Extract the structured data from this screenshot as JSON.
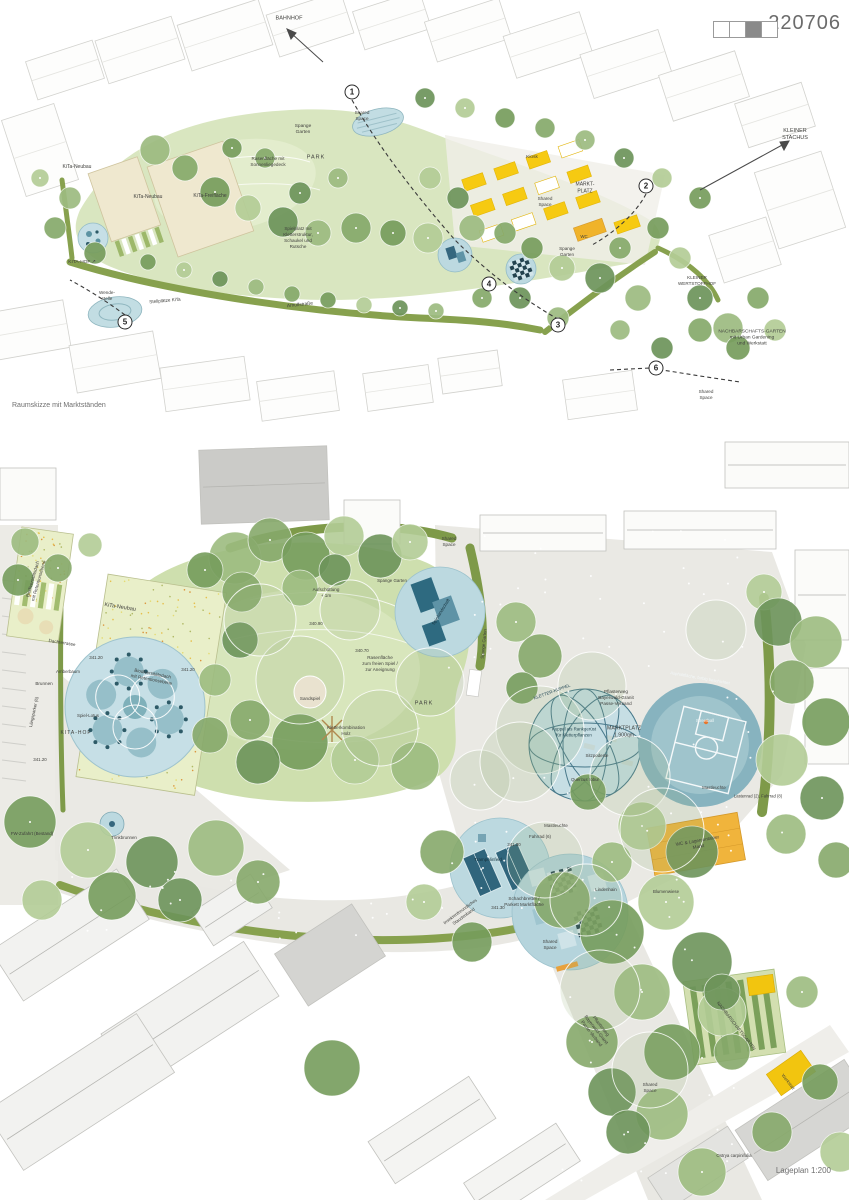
{
  "header": {
    "entry_number": "220706",
    "legend_cells": [
      "empty",
      "empty",
      "filled",
      "empty"
    ]
  },
  "colors": {
    "accent_yellow": "#f5c816",
    "amber": "#f0b43c",
    "water_blue": "#bcd9e0",
    "dark_teal": "#2f6b80",
    "park_green": "#cfe0af",
    "tree_green": "#86a96a",
    "street_gray": "#eae9e4",
    "roof_green": "#e9efc9",
    "legend_fill": "#8a8a8a"
  },
  "sketch": {
    "caption": "Raumskizze mit Marktständen",
    "labels": [
      {
        "t": "BAHNHOF",
        "x": 289,
        "y": 19,
        "s": 5.5
      },
      {
        "t": "KLEINER\nSTACHUS",
        "x": 795,
        "y": 135,
        "s": 5.5
      },
      {
        "t": "KiTa-Neubau",
        "x": 77,
        "y": 167,
        "s": 5
      },
      {
        "t": "KiTa-Neubau",
        "x": 148,
        "y": 197,
        "s": 5
      },
      {
        "t": "KiTa-Freifläche",
        "x": 210,
        "y": 196,
        "s": 5
      },
      {
        "t": "Spange\nGarten",
        "x": 303,
        "y": 130,
        "s": 4.8
      },
      {
        "t": "PARK",
        "x": 316,
        "y": 158,
        "s": 5.5,
        "ls": 1
      },
      {
        "t": "Rasenfläche mit\nSonnenliegedeck",
        "x": 268,
        "y": 162,
        "s": 4.6
      },
      {
        "t": "Spielplatz mit\nKletterstruktur,\nSchaukel und\nRutsche",
        "x": 298,
        "y": 238,
        "s": 4.6
      },
      {
        "t": "Kiosk",
        "x": 532,
        "y": 158,
        "s": 4.8
      },
      {
        "t": "Shared\nSpace",
        "x": 362,
        "y": 116,
        "s": 4.6
      },
      {
        "t": "Shared\nSpace",
        "x": 545,
        "y": 202,
        "s": 4.6
      },
      {
        "t": "MARKT-\nPLATZ",
        "x": 585,
        "y": 188,
        "s": 5
      },
      {
        "t": "WC",
        "x": 584,
        "y": 237,
        "s": 4.4
      },
      {
        "t": "Spange\nGarten",
        "x": 567,
        "y": 252,
        "s": 4.6
      },
      {
        "t": "KITA-HOF ↗",
        "x": 82,
        "y": 263,
        "s": 4.8
      },
      {
        "t": "Wende-\nstelle",
        "x": 107,
        "y": 296,
        "s": 4.6
      },
      {
        "t": "Stellplätze KiTa",
        "x": 165,
        "y": 301,
        "r": -5,
        "s": 4.6
      },
      {
        "t": "Arnulfstraße",
        "x": 300,
        "y": 306,
        "r": -6,
        "s": 4.8
      },
      {
        "t": "KLEINER\nWERTSTOFFHOF",
        "x": 697,
        "y": 281,
        "s": 4.6
      },
      {
        "t": "NACHBARSCHAFTS-GARTEN\nmit Urban Gardening\nund Werkstatt",
        "x": 752,
        "y": 339,
        "s": 4.8
      },
      {
        "t": "Shared\nSpace",
        "x": 706,
        "y": 395,
        "s": 4.6
      }
    ],
    "numbers": [
      {
        "n": "1",
        "x": 352,
        "y": 92
      },
      {
        "n": "2",
        "x": 646,
        "y": 186
      },
      {
        "n": "3",
        "x": 558,
        "y": 325
      },
      {
        "n": "4",
        "x": 489,
        "y": 284
      },
      {
        "n": "5",
        "x": 125,
        "y": 322
      },
      {
        "n": "6",
        "x": 656,
        "y": 368
      }
    ]
  },
  "plan": {
    "caption": "Lageplan 1:200",
    "labels": [
      {
        "t": "Biodiversitätsdach\nmit Retentionsebene",
        "x": 36,
        "y": 150,
        "r": -74,
        "s": 4.6
      },
      {
        "t": "KiTa-Neubau",
        "x": 120,
        "y": 178,
        "r": 9,
        "s": 5.5
      },
      {
        "t": "Biodiversitätsdach\nmit Retentionsebene",
        "x": 152,
        "y": 247,
        "r": 11,
        "s": 4.6
      },
      {
        "t": "Dachterrasse",
        "x": 62,
        "y": 213,
        "r": 9,
        "s": 4.6
      },
      {
        "t": "341.20",
        "x": 96,
        "y": 228,
        "s": 4.4
      },
      {
        "t": "341.20",
        "x": 188,
        "y": 240,
        "s": 4.4
      },
      {
        "t": "341.20",
        "x": 40,
        "y": 330,
        "s": 4.4
      },
      {
        "t": "Amberbaum",
        "x": 68,
        "y": 242,
        "s": 4.4
      },
      {
        "t": "Brunnen",
        "x": 44,
        "y": 254,
        "s": 4.6
      },
      {
        "t": "Spiel-Lotus",
        "x": 88,
        "y": 286,
        "s": 4.4
      },
      {
        "t": "KITA-HOF",
        "x": 76,
        "y": 303,
        "s": 5,
        "ls": 1
      },
      {
        "t": "Längsparker (6)",
        "x": 34,
        "y": 282,
        "r": -78,
        "s": 4.4
      },
      {
        "t": "FW-Zufahrt (Bestand)",
        "x": 32,
        "y": 404,
        "s": 4.4
      },
      {
        "t": "Trinkbrunnen",
        "x": 124,
        "y": 408,
        "s": 4.4
      },
      {
        "t": "Aufschüttung\n+ 1m",
        "x": 326,
        "y": 163,
        "s": 4.6
      },
      {
        "t": "340.90",
        "x": 316,
        "y": 194,
        "s": 4.4
      },
      {
        "t": "340.70",
        "x": 362,
        "y": 221,
        "s": 4.4
      },
      {
        "t": "Rasenfläche\nzum freien Spiel /\nzur Aneignung",
        "x": 380,
        "y": 234,
        "s": 4.6
      },
      {
        "t": "PARK",
        "x": 424,
        "y": 274,
        "s": 5.5,
        "ls": 1
      },
      {
        "t": "Sandspiel",
        "x": 310,
        "y": 269,
        "s": 4.6
      },
      {
        "t": "Kletterkombination\nHolz",
        "x": 346,
        "y": 301,
        "s": 4.6
      },
      {
        "t": "Spange Garten",
        "x": 392,
        "y": 151,
        "s": 4.4
      },
      {
        "t": "Spange Garten",
        "x": 484,
        "y": 214,
        "r": -84,
        "s": 4.4
      },
      {
        "t": "Spiellandschaft",
        "x": 441,
        "y": 182,
        "r": -58,
        "s": 4.4,
        "c": "#18323c"
      },
      {
        "t": "Shared\nSpace",
        "x": 449,
        "y": 112,
        "s": 4.6
      },
      {
        "t": "KLETTER-KUPPEL",
        "x": 552,
        "y": 262,
        "r": -20,
        "s": 4.4,
        "c": "#2c4f5c"
      },
      {
        "t": "Kuppel als Rankgerüst\nfür Kletterpflanzen",
        "x": 574,
        "y": 302,
        "s": 4.4,
        "c": "#274953"
      },
      {
        "t": "Pflasterweg\nBayerwald-Granit\nPasse-Verband",
        "x": 616,
        "y": 268,
        "s": 4.6
      },
      {
        "t": "MARKTPLATZ\n1.900qm",
        "x": 624,
        "y": 302,
        "s": 5.2
      },
      {
        "t": "Asphaltfläche, farbig beschichtet",
        "x": 700,
        "y": 248,
        "r": 10,
        "s": 4.2,
        "c": "#f2f7f8"
      },
      {
        "t": "Streetball",
        "x": 705,
        "y": 291,
        "s": 4.4,
        "c": "#eef5f6"
      },
      {
        "t": "Sitzpodeste",
        "x": 597,
        "y": 326,
        "s": 4.4
      },
      {
        "t": "Quercus robur",
        "x": 585,
        "y": 350,
        "s": 4.4
      },
      {
        "t": "Mastleuchte",
        "x": 714,
        "y": 358,
        "s": 4.4
      },
      {
        "t": "Lastenrad (2), Fahrrad (8)",
        "x": 758,
        "y": 366,
        "s": 4.2
      },
      {
        "t": "Mastleuchte",
        "x": 556,
        "y": 396,
        "s": 4.4
      },
      {
        "t": "Fahrrad (6)",
        "x": 540,
        "y": 407,
        "s": 4.4
      },
      {
        "t": "341.30",
        "x": 514,
        "y": 415,
        "s": 4.4
      },
      {
        "t": "WC & Lagercontainer\nMarkt",
        "x": 698,
        "y": 414,
        "r": -10,
        "s": 4.6
      },
      {
        "t": "Trampolinfeld",
        "x": 488,
        "y": 430,
        "s": 4.6,
        "c": "#12303c"
      },
      {
        "t": "Schachbretter /\nParkett Marktfläche",
        "x": 524,
        "y": 472,
        "s": 4.6
      },
      {
        "t": "341.30",
        "x": 498,
        "y": 478,
        "s": 4.4
      },
      {
        "t": "Insektenfreundliches\nStaudenband",
        "x": 462,
        "y": 484,
        "r": -36,
        "s": 4.4
      },
      {
        "t": "Shared\nSpace",
        "x": 550,
        "y": 515,
        "s": 4.6
      },
      {
        "t": "Lindenhain",
        "x": 606,
        "y": 460,
        "s": 4.4
      },
      {
        "t": "Blumenwiese",
        "x": 666,
        "y": 462,
        "s": 4.4
      },
      {
        "t": "Pflasterweg\nBayerwald-Granit\nPasse-Verband",
        "x": 596,
        "y": 600,
        "r": 52,
        "s": 4.6
      },
      {
        "t": "Shared\nSpace",
        "x": 650,
        "y": 658,
        "s": 4.6
      },
      {
        "t": "NACHBARSCHAFTSGARTEN",
        "x": 736,
        "y": 596,
        "r": 52,
        "s": 4.4
      },
      {
        "t": "Werkstatt",
        "x": 788,
        "y": 652,
        "r": 52,
        "s": 4.4
      },
      {
        "t": "Ostrya carpinifolia",
        "x": 734,
        "y": 726,
        "s": 4.4
      }
    ]
  }
}
